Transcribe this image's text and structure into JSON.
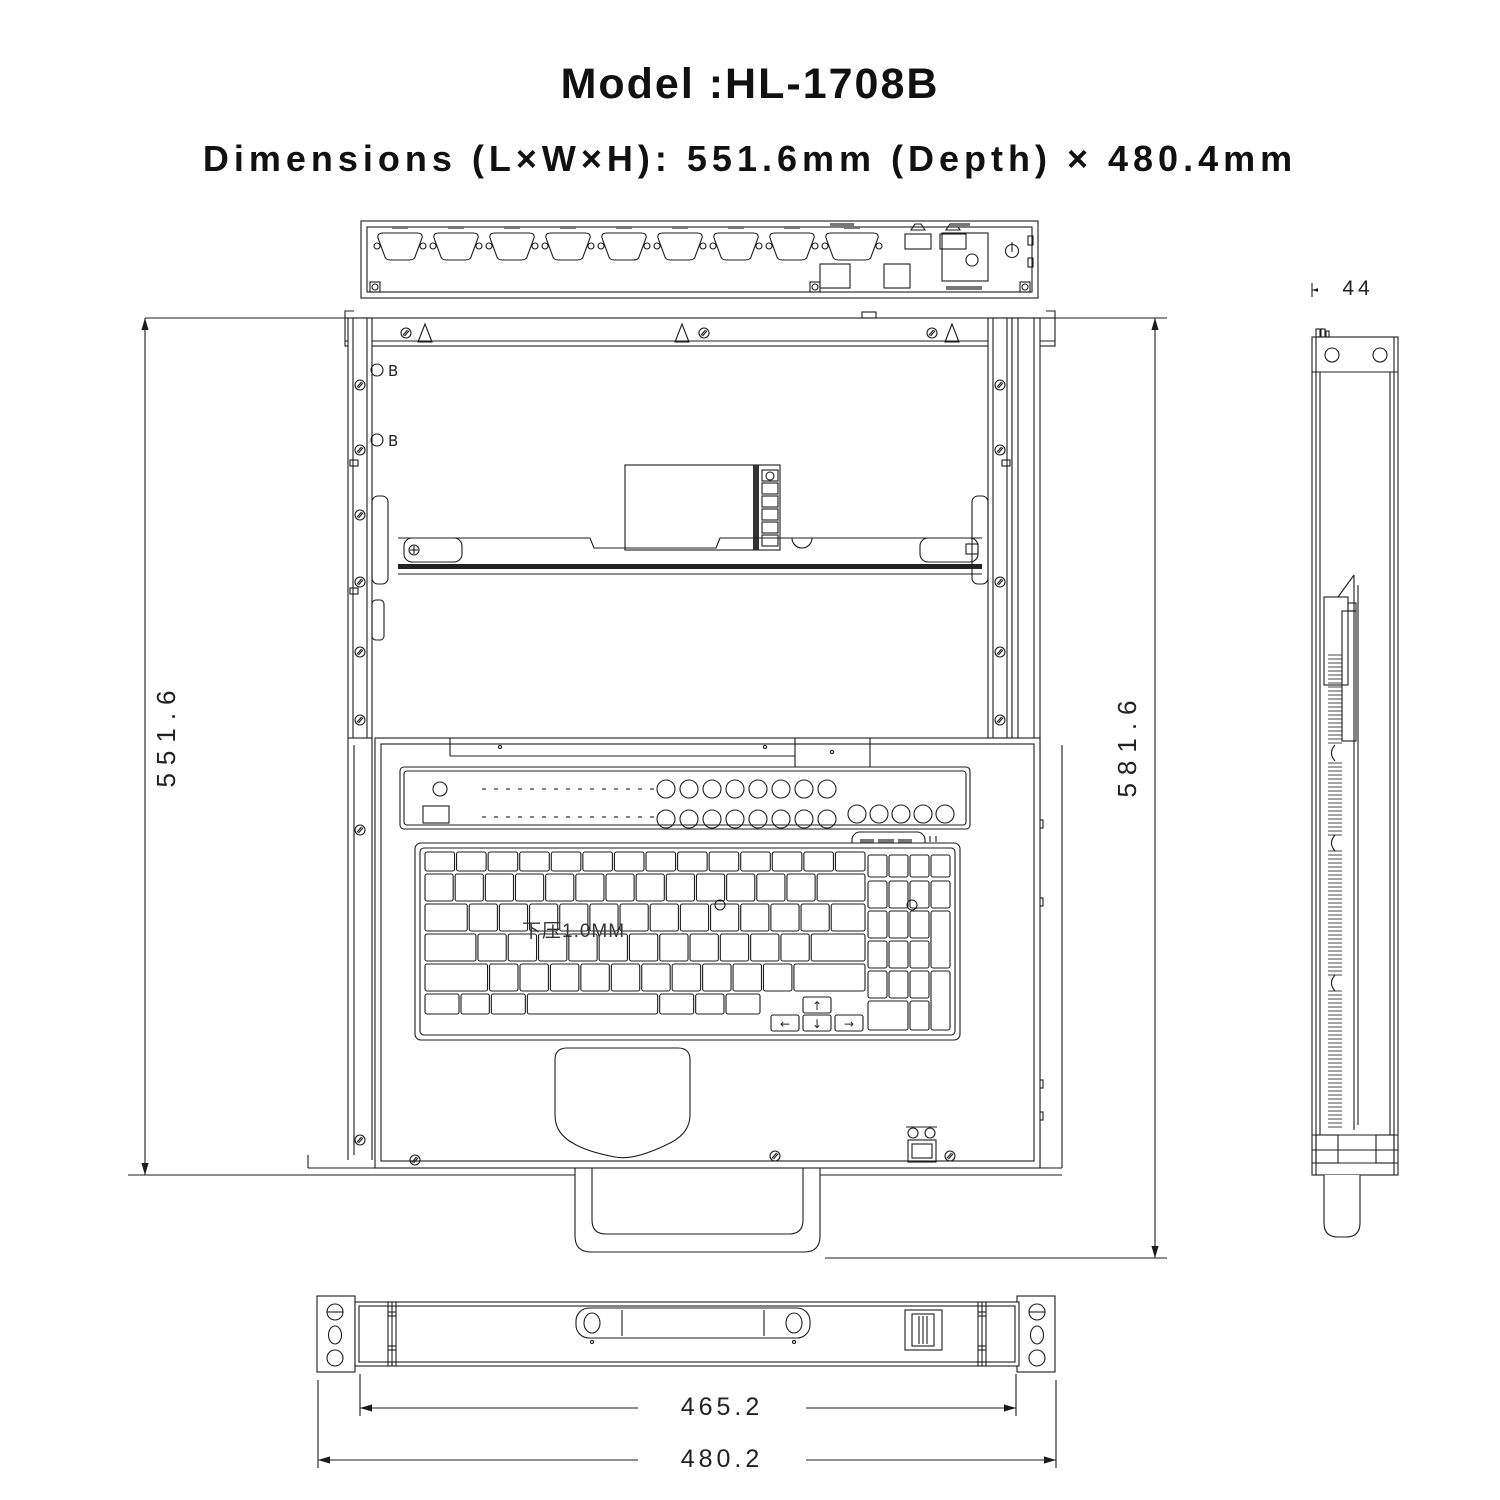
{
  "header": {
    "model_label": "Model :HL-1708B",
    "dimensions_label": "Dimensions (L×W×H): 551.6mm (Depth) × 480.4mm"
  },
  "dimensions": {
    "tray_depth_mm": "551.6",
    "overall_depth_mm": "581.6",
    "panel_height_mm": "44",
    "body_width_mm": "465.2",
    "overall_width_mm": "480.2"
  },
  "annotations": {
    "datum_b": "B",
    "keyboard_note": "下压1.0MM"
  },
  "icons": {
    "arrow_up": "↑",
    "arrow_down": "↓",
    "arrow_left": "←",
    "arrow_right": "→"
  },
  "colors": {
    "line": "#1c1c1c",
    "background": "#ffffff"
  }
}
